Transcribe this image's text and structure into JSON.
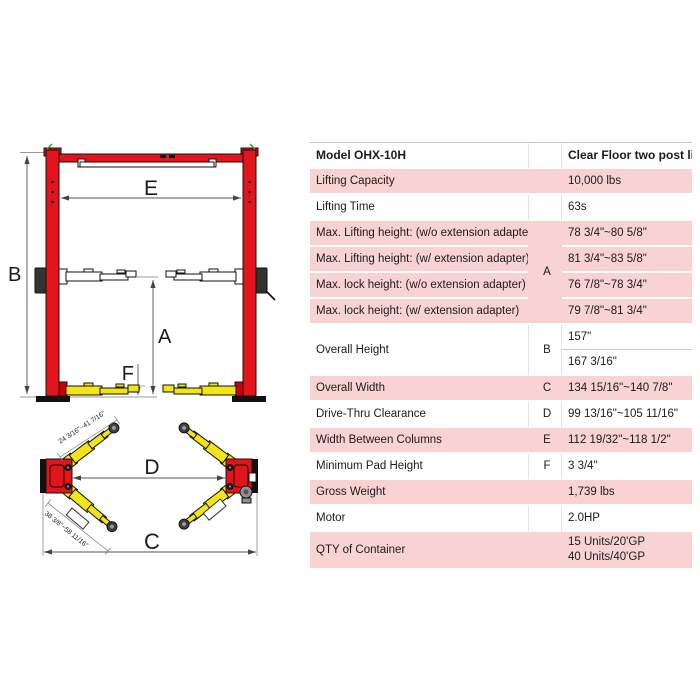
{
  "colors": {
    "accent_red": "#e2151c",
    "accent_yellow": "#f2e418",
    "row_pink": "#f9d2d2"
  },
  "diagram": {
    "dim_labels": {
      "A": "A",
      "B": "B",
      "C": "C",
      "D": "D",
      "E": "E",
      "F": "F"
    },
    "top_view": {
      "front_arm_range": "24 3/16\"~41 7/16\"",
      "rear_arm_range": "38 3/8\"~58 11/16\""
    }
  },
  "table": {
    "header": {
      "model": "Model OHX-10H",
      "product": "Clear Floor two post lift"
    },
    "rows": {
      "lifting_capacity": {
        "label": "Lifting Capacity",
        "value": "10,000 lbs"
      },
      "lifting_time": {
        "label": "Lifting Time",
        "value": "63s"
      },
      "max_lift_wo": {
        "label": "Max. Lifting height: (w/o extension adapter)",
        "letter": "A",
        "value": "78 3/4\"~80 5/8\""
      },
      "max_lift_w": {
        "label": "Max. Lifting height:  (w/ extension adapter)",
        "value": "81 3/4\"~83 5/8\""
      },
      "max_lock_wo": {
        "label": "Max. lock height:  (w/o extension adapter)",
        "value": "76 7/8\"~78 3/4\""
      },
      "max_lock_w": {
        "label": "Max. lock height:  (w/ extension adapter)",
        "value": "79 7/8\"~81 3/4\""
      },
      "overall_height": {
        "label": "Overall Height",
        "letter": "B",
        "value_min": "157\"",
        "value_max": "167 3/16\""
      },
      "overall_width": {
        "label": "Overall Width",
        "letter": "C",
        "value": "134 15/16\"~140 7/8\""
      },
      "drive_thru": {
        "label": "Drive-Thru Clearance",
        "letter": "D",
        "value": "99 13/16\"~105 11/16\""
      },
      "width_between": {
        "label": "Width Between Columns",
        "letter": "E",
        "value": "112 19/32\"~118 1/2\""
      },
      "min_pad_height": {
        "label": "Minimum Pad Height",
        "letter": "F",
        "value": "3  3/4\""
      },
      "gross_weight": {
        "label": "Gross Weight",
        "value": "1,739 lbs"
      },
      "motor": {
        "label": "Motor",
        "value": "2.0HP"
      },
      "qty_container": {
        "label": "QTY of Container",
        "value_line1": "15 Units/20'GP",
        "value_line2": "40 Units/40'GP"
      }
    }
  }
}
